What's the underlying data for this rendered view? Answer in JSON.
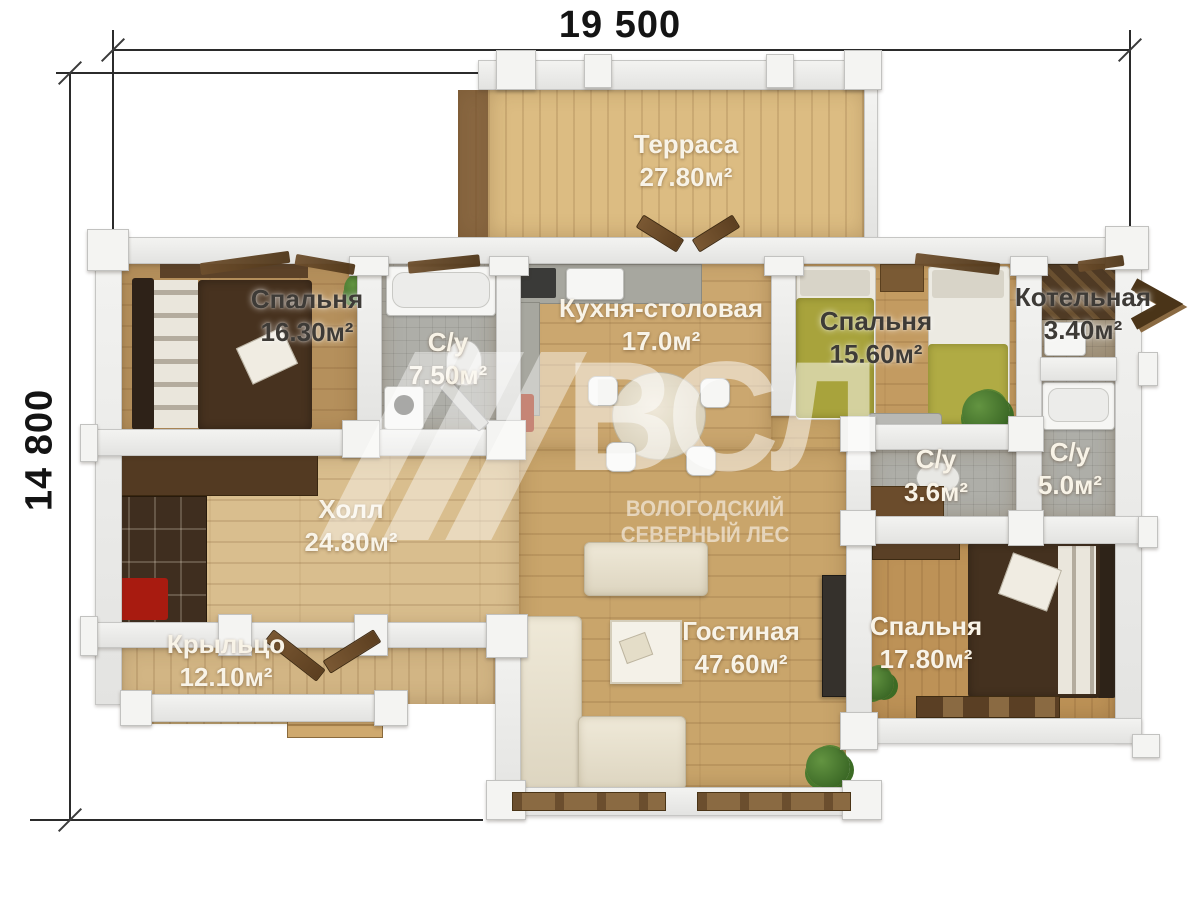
{
  "dimensions": {
    "width_label": "19 500",
    "height_label": "14 800"
  },
  "watermark": {
    "logo": "ВСЛ",
    "subtitle": "ВОЛОГОДСКИЙ СЕВЕРНЫЙ ЛЕС"
  },
  "rooms": [
    {
      "name": "Терраса",
      "area": "27.80м²"
    },
    {
      "name": "Спальня",
      "area": "16.30м²"
    },
    {
      "name": "С/у",
      "area": "7.50м²"
    },
    {
      "name": "Кухня-столовая",
      "area": "17.0м²"
    },
    {
      "name": "Спальня",
      "area": "15.60м²"
    },
    {
      "name": "Котельная",
      "area": "3.40м²"
    },
    {
      "name": "С/у",
      "area": "3.6м²"
    },
    {
      "name": "С/у",
      "area": "5.0м²"
    },
    {
      "name": "Холл",
      "area": "24.80м²"
    },
    {
      "name": "Гостиная",
      "area": "47.60м²"
    },
    {
      "name": "Спальня",
      "area": "17.80м²"
    },
    {
      "name": "Крыльцо",
      "area": "12.10м²"
    }
  ],
  "colors": {
    "wall": "#ececea",
    "wood_floor": "#cba76f",
    "hall_floor": "#d9be8e",
    "terrace_floor": "#dcbc82",
    "tile_floor": "#aeaea8",
    "label_light": "#f8f3e7",
    "label_dark": "#3e3b37",
    "blanket_brown": "#47321f",
    "blanket_olive": "#a8a33c",
    "watermark_white": "rgba(255,255,255,0.5)"
  }
}
